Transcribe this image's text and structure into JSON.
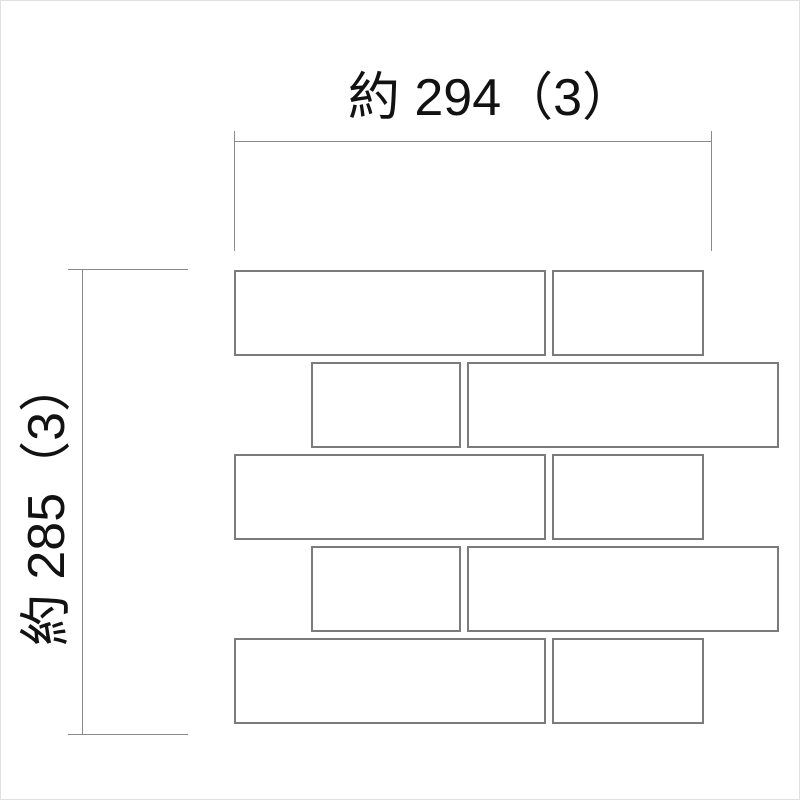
{
  "diagram": {
    "type": "tile-sheet-dimension-drawing",
    "canvas": {
      "width": 800,
      "height": 800,
      "background": "#ffffff",
      "border_color": "#e0e0e0"
    },
    "colors": {
      "dimension_line": "#8a8a8a",
      "brick_outline": "#7b7b7b",
      "brick_fill": "#ffffff",
      "text": "#121212"
    },
    "horizontal_dimension": {
      "label": "約 294（3）",
      "approx_value_mm": 294,
      "joint_mm": 3
    },
    "vertical_dimension": {
      "label": "約 285（3）",
      "approx_value_mm": 285,
      "joint_mm": 3
    },
    "lines": [
      {
        "name": "h-dimension-line",
        "x": 233,
        "y": 140,
        "w": 478,
        "h": 1
      },
      {
        "name": "h-dimension-extension-left",
        "x": 233,
        "y": 130,
        "w": 1,
        "h": 120
      },
      {
        "name": "h-dimension-extension-right",
        "x": 710,
        "y": 130,
        "w": 1,
        "h": 120
      },
      {
        "name": "v-dimension-line",
        "x": 81,
        "y": 268,
        "w": 1,
        "h": 465
      },
      {
        "name": "v-dimension-extension-top",
        "x": 67,
        "y": 268,
        "w": 120,
        "h": 1
      },
      {
        "name": "v-dimension-extension-bottom",
        "x": 67,
        "y": 733,
        "w": 120,
        "h": 1
      }
    ],
    "bricks": [
      {
        "row": 1,
        "x": 233,
        "y": 269,
        "w": 312,
        "h": 86
      },
      {
        "row": 1,
        "x": 551,
        "y": 269,
        "w": 152,
        "h": 86
      },
      {
        "row": 2,
        "x": 310,
        "y": 361,
        "w": 150,
        "h": 86
      },
      {
        "row": 2,
        "x": 466,
        "y": 361,
        "w": 312,
        "h": 86
      },
      {
        "row": 3,
        "x": 233,
        "y": 453,
        "w": 312,
        "h": 86
      },
      {
        "row": 3,
        "x": 551,
        "y": 453,
        "w": 152,
        "h": 86
      },
      {
        "row": 4,
        "x": 310,
        "y": 545,
        "w": 150,
        "h": 86
      },
      {
        "row": 4,
        "x": 466,
        "y": 545,
        "w": 312,
        "h": 86
      },
      {
        "row": 5,
        "x": 233,
        "y": 637,
        "w": 312,
        "h": 86
      },
      {
        "row": 5,
        "x": 551,
        "y": 637,
        "w": 152,
        "h": 86
      }
    ]
  }
}
